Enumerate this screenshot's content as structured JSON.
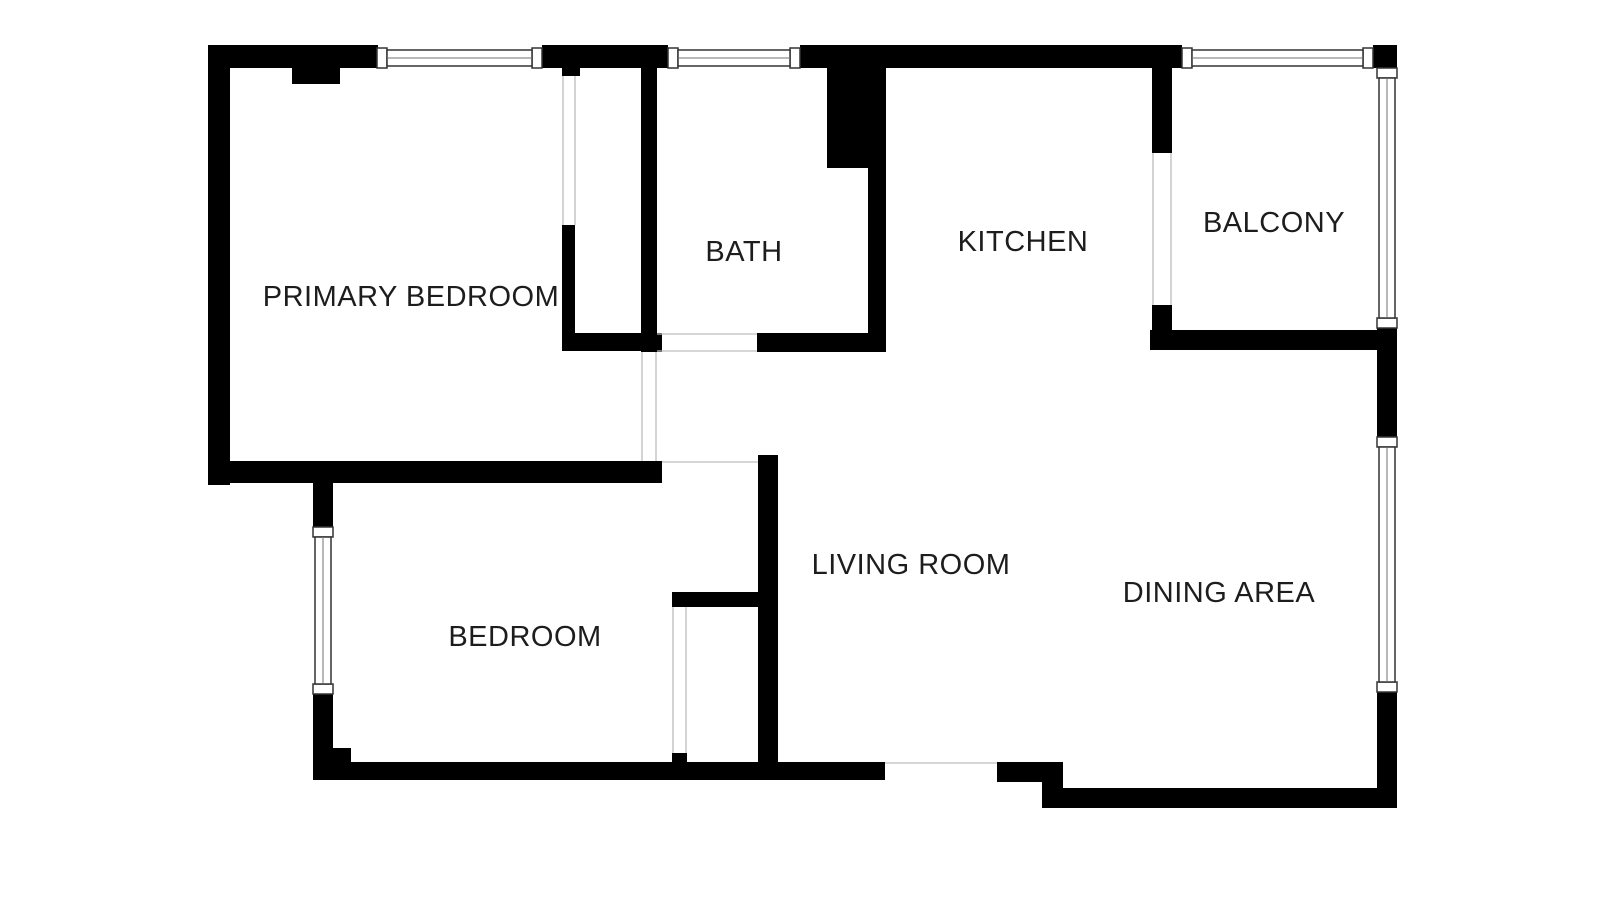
{
  "floorplan": {
    "canvas": {
      "width": 1600,
      "height": 900
    },
    "colors": {
      "background": "#ffffff",
      "wall": "#000000",
      "window_frame": "#333333",
      "glazing": "#707070",
      "opening_line": "#bdbdbd",
      "label": "#1d1d1d"
    },
    "rooms": [
      {
        "id": "primary-bedroom",
        "label": "PRIMARY BEDROOM",
        "cx": 411,
        "cy": 297
      },
      {
        "id": "bath",
        "label": "BATH",
        "cx": 744,
        "cy": 252
      },
      {
        "id": "kitchen",
        "label": "KITCHEN",
        "cx": 1023,
        "cy": 242
      },
      {
        "id": "balcony",
        "label": "BALCONY",
        "cx": 1274,
        "cy": 223
      },
      {
        "id": "bedroom",
        "label": "BEDROOM",
        "cx": 525,
        "cy": 637
      },
      {
        "id": "living-room",
        "label": "LIVING ROOM",
        "cx": 911,
        "cy": 565
      },
      {
        "id": "dining-area",
        "label": "DINING AREA",
        "cx": 1219,
        "cy": 593
      }
    ],
    "walls": [
      {
        "x": 208,
        "y": 45,
        "w": 170,
        "h": 23
      },
      {
        "x": 542,
        "y": 45,
        "w": 126,
        "h": 23
      },
      {
        "x": 800,
        "y": 45,
        "w": 382,
        "h": 23
      },
      {
        "x": 1373,
        "y": 45,
        "w": 24,
        "h": 23
      },
      {
        "x": 208,
        "y": 45,
        "w": 22,
        "h": 440
      },
      {
        "x": 292,
        "y": 67,
        "w": 48,
        "h": 17
      },
      {
        "x": 827,
        "y": 45,
        "w": 59,
        "h": 123
      },
      {
        "x": 641,
        "y": 67,
        "w": 16,
        "h": 285
      },
      {
        "x": 868,
        "y": 168,
        "w": 18,
        "h": 184
      },
      {
        "x": 757,
        "y": 333,
        "w": 129,
        "h": 19
      },
      {
        "x": 641,
        "y": 333,
        "w": 21,
        "h": 19
      },
      {
        "x": 562,
        "y": 65,
        "w": 18,
        "h": 11
      },
      {
        "x": 562,
        "y": 225,
        "w": 13,
        "h": 126
      },
      {
        "x": 562,
        "y": 333,
        "w": 95,
        "h": 18
      },
      {
        "x": 208,
        "y": 461,
        "w": 454,
        "h": 22
      },
      {
        "x": 313,
        "y": 461,
        "w": 20,
        "h": 66
      },
      {
        "x": 313,
        "y": 694,
        "w": 20,
        "h": 86
      },
      {
        "x": 333,
        "y": 748,
        "w": 18,
        "h": 14
      },
      {
        "x": 313,
        "y": 762,
        "w": 572,
        "h": 18
      },
      {
        "x": 672,
        "y": 753,
        "w": 15,
        "h": 9
      },
      {
        "x": 672,
        "y": 592,
        "w": 93,
        "h": 15
      },
      {
        "x": 758,
        "y": 455,
        "w": 20,
        "h": 325
      },
      {
        "x": 997,
        "y": 762,
        "w": 66,
        "h": 20
      },
      {
        "x": 1042,
        "y": 762,
        "w": 21,
        "h": 46
      },
      {
        "x": 1042,
        "y": 788,
        "w": 355,
        "h": 20
      },
      {
        "x": 1377,
        "y": 692,
        "w": 20,
        "h": 116
      },
      {
        "x": 1377,
        "y": 328,
        "w": 20,
        "h": 109
      },
      {
        "x": 1150,
        "y": 330,
        "w": 247,
        "h": 20
      },
      {
        "x": 1152,
        "y": 67,
        "w": 20,
        "h": 86
      },
      {
        "x": 1152,
        "y": 305,
        "w": 20,
        "h": 25
      }
    ],
    "windows": [
      {
        "x": 377,
        "y": 48,
        "w": 165,
        "h": 20,
        "o": "h"
      },
      {
        "x": 668,
        "y": 48,
        "w": 132,
        "h": 20,
        "o": "h"
      },
      {
        "x": 1182,
        "y": 48,
        "w": 191,
        "h": 20,
        "o": "h"
      },
      {
        "x": 313,
        "y": 527,
        "w": 20,
        "h": 167,
        "o": "v"
      },
      {
        "x": 1377,
        "y": 68,
        "w": 20,
        "h": 260,
        "o": "v"
      },
      {
        "x": 1377,
        "y": 437,
        "w": 20,
        "h": 255,
        "o": "v"
      }
    ],
    "openings": [
      {
        "x1": 563,
        "y1": 76,
        "x2": 563,
        "y2": 225
      },
      {
        "x1": 575,
        "y1": 76,
        "x2": 575,
        "y2": 225
      },
      {
        "x1": 642,
        "y1": 352,
        "x2": 642,
        "y2": 461
      },
      {
        "x1": 656,
        "y1": 352,
        "x2": 656,
        "y2": 461
      },
      {
        "x1": 657,
        "y1": 334,
        "x2": 757,
        "y2": 334
      },
      {
        "x1": 657,
        "y1": 351,
        "x2": 757,
        "y2": 351
      },
      {
        "x1": 1153,
        "y1": 153,
        "x2": 1153,
        "y2": 305
      },
      {
        "x1": 1171,
        "y1": 153,
        "x2": 1171,
        "y2": 305
      },
      {
        "x1": 662,
        "y1": 462,
        "x2": 758,
        "y2": 462
      },
      {
        "x1": 673,
        "y1": 607,
        "x2": 673,
        "y2": 753
      },
      {
        "x1": 686,
        "y1": 607,
        "x2": 686,
        "y2": 753
      },
      {
        "x1": 885,
        "y1": 763,
        "x2": 997,
        "y2": 763
      }
    ]
  }
}
